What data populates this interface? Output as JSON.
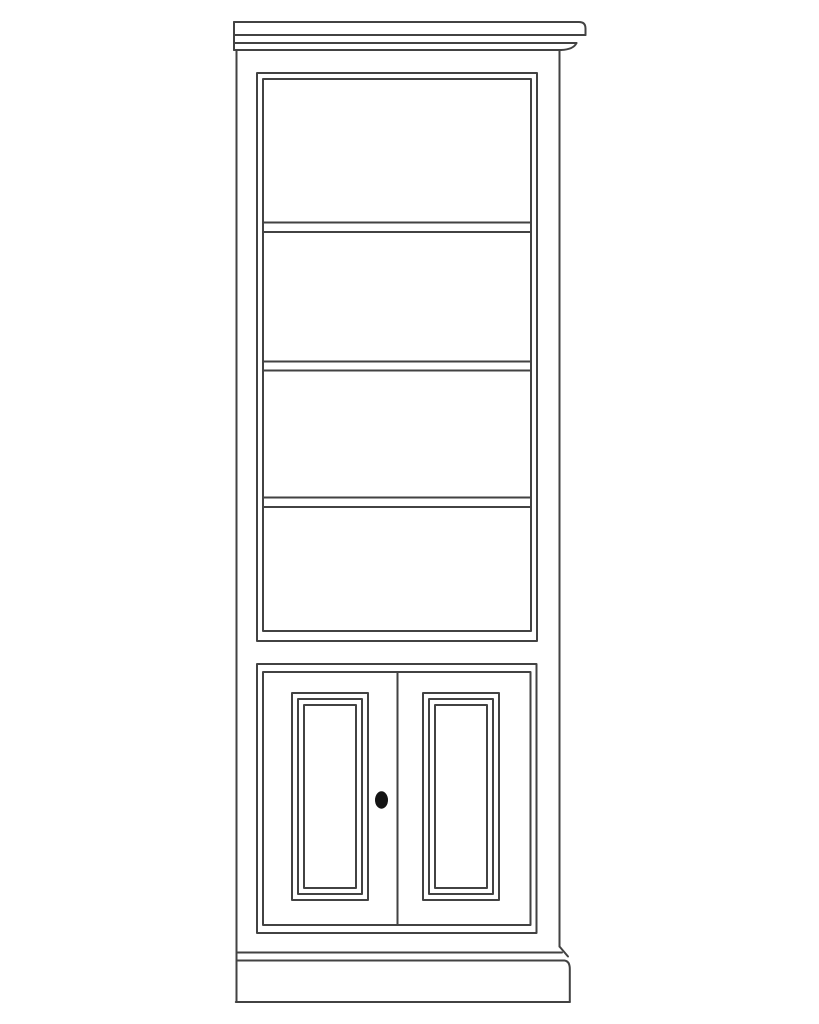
{
  "figure": {
    "name": "bookcase-with-lower-doors-line-drawing",
    "shelf_compartments": 4,
    "shelf_count": 3,
    "door_count": 2,
    "knob_count": 1
  },
  "colors": {
    "background": "#ffffff",
    "line": "#424242",
    "knob": "#141414"
  }
}
